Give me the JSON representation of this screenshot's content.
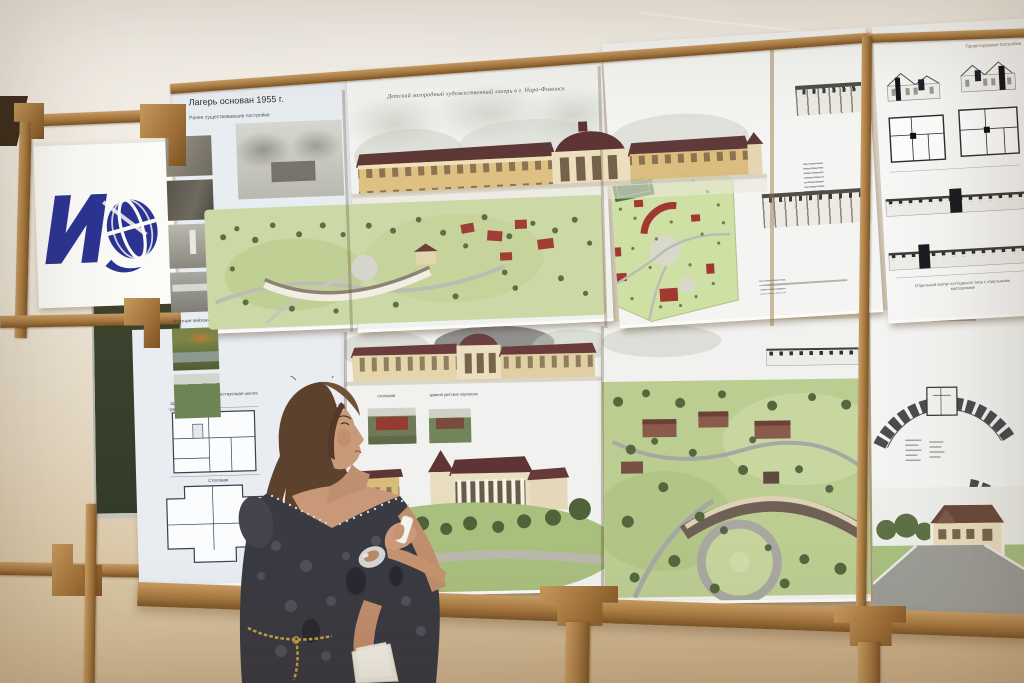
{
  "scene": {
    "setting": "exhibition room, architectural presentation boards on wooden easel frames",
    "subject": "woman in dark patterned dress with remote, viewing the boards"
  },
  "boards": {
    "camp_history": {
      "title": "Лагерь основан 1955 г.",
      "subtitle": "Ранее существовавшие постройки",
      "photos_label": "Местные пейзажи"
    },
    "main": {
      "title": "Детский загородный художественный лагерь в г. Наро-Фоминск"
    },
    "projected": {
      "title": "Проектируемые постройки",
      "caption": "Отдельный корпус коттеджного типа с отдельными мастерскими"
    },
    "plans": {
      "label_top": "существующая школа",
      "heading": "Здание спортивно-развлекательного",
      "label": "Столовая"
    },
    "site": {
      "label_center": "столовая",
      "label_right": "здания детских корпусов"
    }
  },
  "colors": {
    "wall": "#ece4d4",
    "wood": "#a87a42",
    "logo_blue": "#2c3492",
    "board": "#f1f2ef",
    "chalkboard": "#39422f",
    "lawn": "#bccd92",
    "roof": "#5f3838"
  }
}
